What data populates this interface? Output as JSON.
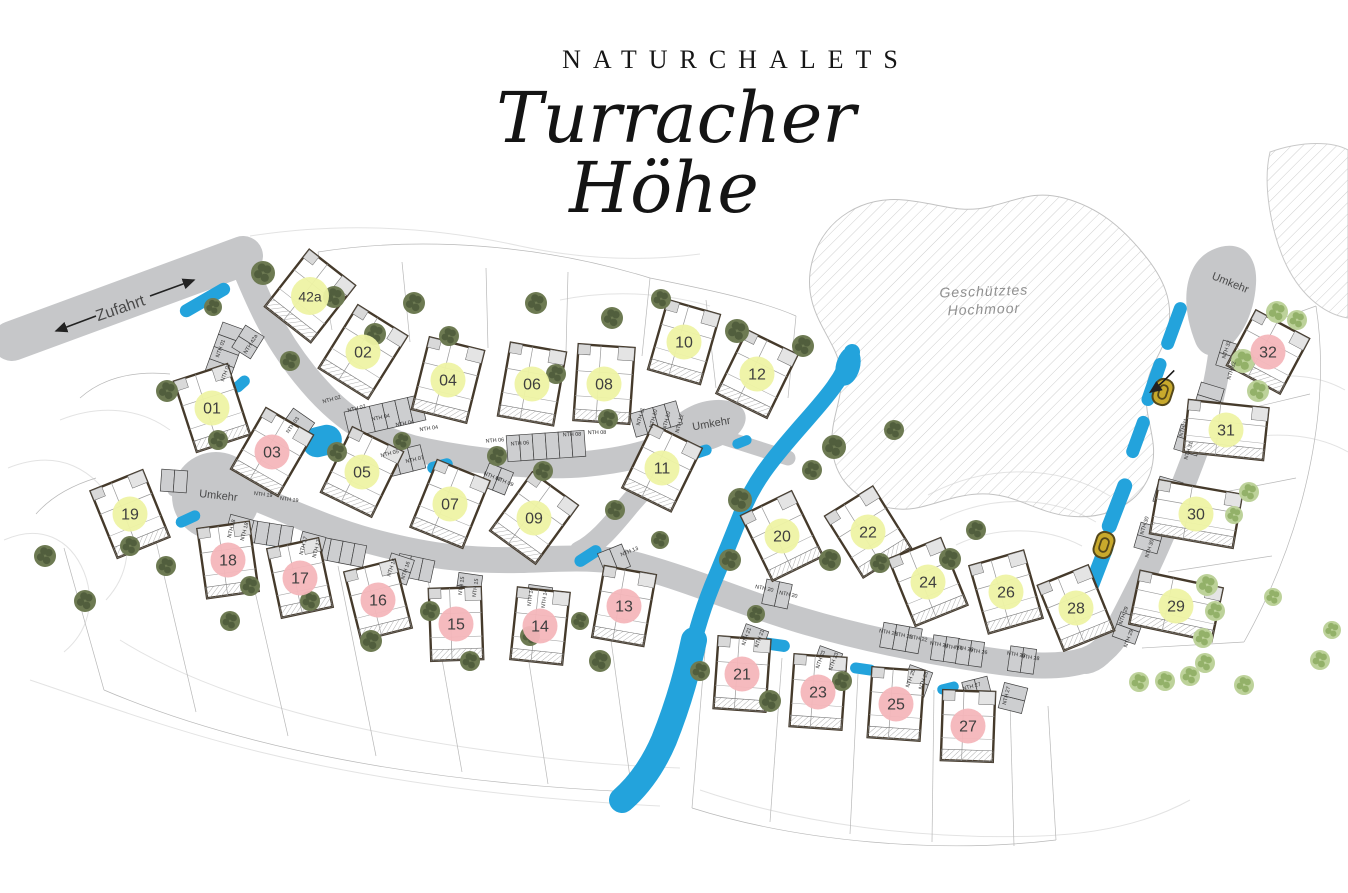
{
  "title": {
    "kicker": "NATURCHALETS",
    "line1": "Turracher",
    "line2": "Höhe"
  },
  "map_labels": {
    "zufahrt": "Zufahrt",
    "umkehr": "Umkehr",
    "moor1": "Geschütztes",
    "moor2": "Hochmoor"
  },
  "colors": {
    "badge_yellow": "#eef3a4",
    "badge_pink": "#f4b6ba",
    "road": "#c6c7c9",
    "water": "#23a3dc",
    "tree_dark": "#6d7a52",
    "tree_dark_spot": "#515e3d",
    "tree_light": "#bdd29a",
    "tree_light_spot": "#93b169",
    "wall": "#453a2b",
    "marker": "#c8a92c"
  },
  "umkehr_positions": [
    {
      "x": 218,
      "y": 499,
      "r": 6
    },
    {
      "x": 712,
      "y": 427,
      "r": -10
    },
    {
      "x": 1229,
      "y": 286,
      "r": 22
    }
  ],
  "moor_label_pos": {
    "x": 984,
    "y": 298
  },
  "zufahrt_pos": {
    "x": 122,
    "y": 313,
    "r": -19
  },
  "houses": [
    {
      "id": "42a",
      "x": 310,
      "y": 296,
      "rot": 38,
      "w": 58,
      "h": 72,
      "status": "yellow"
    },
    {
      "id": "01",
      "x": 212,
      "y": 408,
      "rot": -18,
      "w": 56,
      "h": 74,
      "status": "yellow"
    },
    {
      "id": "02",
      "x": 363,
      "y": 352,
      "rot": 32,
      "w": 58,
      "h": 74,
      "status": "yellow"
    },
    {
      "id": "03",
      "x": 272,
      "y": 452,
      "rot": 30,
      "w": 54,
      "h": 70,
      "status": "pink"
    },
    {
      "id": "04",
      "x": 448,
      "y": 380,
      "rot": 14,
      "w": 56,
      "h": 74,
      "status": "yellow"
    },
    {
      "id": "05",
      "x": 362,
      "y": 472,
      "rot": 26,
      "w": 56,
      "h": 72,
      "status": "yellow"
    },
    {
      "id": "06",
      "x": 532,
      "y": 384,
      "rot": 10,
      "w": 56,
      "h": 74,
      "status": "yellow"
    },
    {
      "id": "07",
      "x": 450,
      "y": 504,
      "rot": 22,
      "w": 56,
      "h": 72,
      "status": "yellow"
    },
    {
      "id": "08",
      "x": 604,
      "y": 384,
      "rot": 4,
      "w": 56,
      "h": 76,
      "status": "yellow"
    },
    {
      "id": "09",
      "x": 534,
      "y": 518,
      "rot": 36,
      "w": 56,
      "h": 72,
      "status": "yellow"
    },
    {
      "id": "10",
      "x": 684,
      "y": 342,
      "rot": 16,
      "w": 54,
      "h": 72,
      "status": "yellow"
    },
    {
      "id": "11",
      "x": 662,
      "y": 468,
      "rot": 26,
      "w": 54,
      "h": 70,
      "status": "yellow"
    },
    {
      "id": "12",
      "x": 757,
      "y": 374,
      "rot": 26,
      "w": 56,
      "h": 70,
      "status": "yellow"
    },
    {
      "id": "13",
      "x": 624,
      "y": 606,
      "rot": 10,
      "w": 52,
      "h": 72,
      "status": "pink"
    },
    {
      "id": "14",
      "x": 540,
      "y": 626,
      "rot": 6,
      "w": 52,
      "h": 72,
      "status": "pink"
    },
    {
      "id": "15",
      "x": 456,
      "y": 624,
      "rot": -2,
      "w": 52,
      "h": 72,
      "status": "pink"
    },
    {
      "id": "16",
      "x": 378,
      "y": 600,
      "rot": -14,
      "w": 52,
      "h": 70,
      "status": "pink"
    },
    {
      "id": "17",
      "x": 300,
      "y": 578,
      "rot": -12,
      "w": 52,
      "h": 70,
      "status": "pink"
    },
    {
      "id": "18",
      "x": 228,
      "y": 560,
      "rot": -8,
      "w": 52,
      "h": 70,
      "status": "pink"
    },
    {
      "id": "19",
      "x": 130,
      "y": 514,
      "rot": -22,
      "w": 56,
      "h": 72,
      "status": "yellow"
    },
    {
      "id": "20",
      "x": 782,
      "y": 536,
      "rot": -26,
      "w": 56,
      "h": 72,
      "status": "yellow"
    },
    {
      "id": "21",
      "x": 742,
      "y": 674,
      "rot": 4,
      "w": 52,
      "h": 72,
      "status": "pink"
    },
    {
      "id": "22",
      "x": 868,
      "y": 532,
      "rot": -32,
      "w": 56,
      "h": 72,
      "status": "yellow"
    },
    {
      "id": "23",
      "x": 818,
      "y": 692,
      "rot": 4,
      "w": 52,
      "h": 72,
      "status": "pink"
    },
    {
      "id": "24",
      "x": 928,
      "y": 582,
      "rot": -22,
      "w": 56,
      "h": 72,
      "status": "yellow"
    },
    {
      "id": "25",
      "x": 896,
      "y": 704,
      "rot": 4,
      "w": 52,
      "h": 70,
      "status": "pink"
    },
    {
      "id": "26",
      "x": 1006,
      "y": 592,
      "rot": -16,
      "w": 56,
      "h": 70,
      "status": "yellow"
    },
    {
      "id": "27",
      "x": 968,
      "y": 726,
      "rot": 2,
      "w": 52,
      "h": 70,
      "status": "pink"
    },
    {
      "id": "28",
      "x": 1076,
      "y": 608,
      "rot": -22,
      "w": 54,
      "h": 70,
      "status": "yellow"
    },
    {
      "id": "29",
      "x": 1176,
      "y": 606,
      "rot": 12,
      "w": 84,
      "h": 54,
      "status": "yellow"
    },
    {
      "id": "30",
      "x": 1196,
      "y": 514,
      "rot": 10,
      "w": 84,
      "h": 54,
      "status": "yellow"
    },
    {
      "id": "31",
      "x": 1226,
      "y": 430,
      "rot": 6,
      "w": 80,
      "h": 52,
      "status": "yellow"
    },
    {
      "id": "32",
      "x": 1268,
      "y": 352,
      "rot": 28,
      "w": 60,
      "h": 62,
      "status": "pink"
    }
  ],
  "nth_labels": [
    {
      "t": "NTH 01",
      "x": 222,
      "y": 349,
      "r": -70
    },
    {
      "t": "NTH 01",
      "x": 227,
      "y": 373,
      "r": -70
    },
    {
      "t": "NTH 42a",
      "x": 252,
      "y": 345,
      "r": -58
    },
    {
      "t": "NTH 02",
      "x": 332,
      "y": 401,
      "r": -15
    },
    {
      "t": "NTH 02",
      "x": 357,
      "y": 410,
      "r": -14
    },
    {
      "t": "NTH 04",
      "x": 381,
      "y": 419,
      "r": -12
    },
    {
      "t": "NTH 04",
      "x": 405,
      "y": 425,
      "r": -10
    },
    {
      "t": "NTH 04",
      "x": 429,
      "y": 430,
      "r": -8
    },
    {
      "t": "NTH 06",
      "x": 495,
      "y": 442,
      "r": -5
    },
    {
      "t": "NTH 06",
      "x": 520,
      "y": 445,
      "r": -4
    },
    {
      "t": "NTH 08",
      "x": 572,
      "y": 436,
      "r": -2
    },
    {
      "t": "NTH 08",
      "x": 597,
      "y": 434,
      "r": -1
    },
    {
      "t": "NTH 03",
      "x": 294,
      "y": 426,
      "r": -55
    },
    {
      "t": "NTH 05",
      "x": 390,
      "y": 455,
      "r": -14
    },
    {
      "t": "NTH 07",
      "x": 415,
      "y": 461,
      "r": -13
    },
    {
      "t": "NTH 07",
      "x": 492,
      "y": 478,
      "r": 22
    },
    {
      "t": "NTH 09",
      "x": 504,
      "y": 483,
      "r": 22
    },
    {
      "t": "NTH 11",
      "x": 642,
      "y": 417,
      "r": -75
    },
    {
      "t": "NTH 10",
      "x": 655,
      "y": 419,
      "r": -75
    },
    {
      "t": "NTH 10",
      "x": 668,
      "y": 421,
      "r": -75
    },
    {
      "t": "NTH 12",
      "x": 681,
      "y": 424,
      "r": -75
    },
    {
      "t": "NTH 13",
      "x": 630,
      "y": 553,
      "r": -22
    },
    {
      "t": "NTH 14",
      "x": 532,
      "y": 597,
      "r": -82
    },
    {
      "t": "NTH 14",
      "x": 546,
      "y": 599,
      "r": -82
    },
    {
      "t": "NTH 15",
      "x": 463,
      "y": 586,
      "r": -82
    },
    {
      "t": "NTH 15",
      "x": 477,
      "y": 588,
      "r": -82
    },
    {
      "t": "NTH 16",
      "x": 393,
      "y": 568,
      "r": -72
    },
    {
      "t": "NTH 16",
      "x": 407,
      "y": 571,
      "r": -72
    },
    {
      "t": "NTH 17",
      "x": 305,
      "y": 546,
      "r": -75
    },
    {
      "t": "NTH 17",
      "x": 318,
      "y": 549,
      "r": -75
    },
    {
      "t": "NTH 18",
      "x": 233,
      "y": 529,
      "r": -75
    },
    {
      "t": "NTH 18",
      "x": 246,
      "y": 532,
      "r": -75
    },
    {
      "t": "NTH 19",
      "x": 263,
      "y": 496,
      "r": 7
    },
    {
      "t": "NTH 19",
      "x": 289,
      "y": 501,
      "r": 8
    },
    {
      "t": "NTH 20",
      "x": 764,
      "y": 590,
      "r": 12
    },
    {
      "t": "NTH 20",
      "x": 788,
      "y": 596,
      "r": 12
    },
    {
      "t": "NTH 21",
      "x": 748,
      "y": 637,
      "r": -70
    },
    {
      "t": "NTH 21",
      "x": 761,
      "y": 639,
      "r": -70
    },
    {
      "t": "NTH 22",
      "x": 888,
      "y": 634,
      "r": 10
    },
    {
      "t": "NTH 22",
      "x": 903,
      "y": 637,
      "r": 10
    },
    {
      "t": "NTH 22",
      "x": 918,
      "y": 640,
      "r": 10
    },
    {
      "t": "NTH 23",
      "x": 822,
      "y": 660,
      "r": -70
    },
    {
      "t": "NTH 23",
      "x": 835,
      "y": 662,
      "r": -70
    },
    {
      "t": "NTH 24",
      "x": 939,
      "y": 646,
      "r": 8
    },
    {
      "t": "NTH 24",
      "x": 953,
      "y": 649,
      "r": 8
    },
    {
      "t": "NTH 26",
      "x": 964,
      "y": 650,
      "r": 8
    },
    {
      "t": "NTH 26",
      "x": 978,
      "y": 653,
      "r": 8
    },
    {
      "t": "NTH 25",
      "x": 912,
      "y": 679,
      "r": -70
    },
    {
      "t": "NTH 25",
      "x": 925,
      "y": 681,
      "r": -70
    },
    {
      "t": "NTH 28",
      "x": 1016,
      "y": 656,
      "r": 8
    },
    {
      "t": "NTH 28",
      "x": 1030,
      "y": 659,
      "r": 8
    },
    {
      "t": "NTH 27",
      "x": 972,
      "y": 688,
      "r": -14
    },
    {
      "t": "NTH 27",
      "x": 1008,
      "y": 696,
      "r": -76
    },
    {
      "t": "NTH 29",
      "x": 1125,
      "y": 616,
      "r": -70
    },
    {
      "t": "NTH 29",
      "x": 1130,
      "y": 639,
      "r": -70
    },
    {
      "t": "NTH 30",
      "x": 1146,
      "y": 526,
      "r": -73
    },
    {
      "t": "NTH 30",
      "x": 1151,
      "y": 549,
      "r": -73
    },
    {
      "t": "NTH 31",
      "x": 1185,
      "y": 428,
      "r": -73
    },
    {
      "t": "NTH 31",
      "x": 1190,
      "y": 451,
      "r": -73
    },
    {
      "t": "NTH 32",
      "x": 1228,
      "y": 350,
      "r": -73
    },
    {
      "t": "NTH 32",
      "x": 1233,
      "y": 371,
      "r": -73
    }
  ],
  "parking_rows": [
    {
      "x": 224,
      "y": 357,
      "r": -70,
      "n": 5,
      "bw": 13,
      "bh": 26
    },
    {
      "x": 248,
      "y": 342,
      "r": -58,
      "n": 2,
      "bw": 13,
      "bh": 22
    },
    {
      "x": 385,
      "y": 416,
      "r": -13,
      "n": 6,
      "bw": 13,
      "bh": 26
    },
    {
      "x": 546,
      "y": 446,
      "r": -4,
      "n": 6,
      "bw": 13,
      "bh": 26
    },
    {
      "x": 656,
      "y": 419,
      "r": -16,
      "n": 4,
      "bw": 12,
      "bh": 24
    },
    {
      "x": 296,
      "y": 427,
      "r": -55,
      "n": 2,
      "bw": 14,
      "bh": 26
    },
    {
      "x": 404,
      "y": 461,
      "r": -14,
      "n": 3,
      "bw": 13,
      "bh": 24
    },
    {
      "x": 497,
      "y": 479,
      "r": 22,
      "n": 2,
      "bw": 13,
      "bh": 24
    },
    {
      "x": 174,
      "y": 481,
      "r": 4,
      "n": 2,
      "bw": 13,
      "bh": 22
    },
    {
      "x": 268,
      "y": 534,
      "r": 9,
      "n": 4,
      "bw": 12,
      "bh": 22
    },
    {
      "x": 341,
      "y": 552,
      "r": 11,
      "n": 4,
      "bw": 12,
      "bh": 22
    },
    {
      "x": 415,
      "y": 568,
      "r": 12,
      "n": 3,
      "bw": 12,
      "bh": 22
    },
    {
      "x": 239,
      "y": 530,
      "r": -75,
      "n": 2,
      "bw": 13,
      "bh": 24
    },
    {
      "x": 311,
      "y": 547,
      "r": -75,
      "n": 2,
      "bw": 13,
      "bh": 24
    },
    {
      "x": 399,
      "y": 569,
      "r": -72,
      "n": 2,
      "bw": 13,
      "bh": 24
    },
    {
      "x": 469,
      "y": 587,
      "r": -82,
      "n": 2,
      "bw": 13,
      "bh": 24
    },
    {
      "x": 539,
      "y": 599,
      "r": -82,
      "n": 2,
      "bw": 13,
      "bh": 24
    },
    {
      "x": 614,
      "y": 560,
      "r": -22,
      "n": 2,
      "bw": 13,
      "bh": 24
    },
    {
      "x": 777,
      "y": 594,
      "r": 12,
      "n": 2,
      "bw": 13,
      "bh": 25
    },
    {
      "x": 901,
      "y": 638,
      "r": 10,
      "n": 3,
      "bw": 13,
      "bh": 25
    },
    {
      "x": 945,
      "y": 649,
      "r": 8,
      "n": 2,
      "bw": 13,
      "bh": 25
    },
    {
      "x": 970,
      "y": 653,
      "r": 8,
      "n": 2,
      "bw": 13,
      "bh": 25
    },
    {
      "x": 1022,
      "y": 660,
      "r": 8,
      "n": 2,
      "bw": 13,
      "bh": 25
    },
    {
      "x": 753,
      "y": 640,
      "r": -70,
      "n": 2,
      "bw": 13,
      "bh": 24
    },
    {
      "x": 827,
      "y": 662,
      "r": -70,
      "n": 2,
      "bw": 13,
      "bh": 24
    },
    {
      "x": 917,
      "y": 681,
      "r": -70,
      "n": 2,
      "bw": 13,
      "bh": 24
    },
    {
      "x": 1013,
      "y": 698,
      "r": -76,
      "n": 2,
      "bw": 13,
      "bh": 24
    },
    {
      "x": 977,
      "y": 690,
      "r": -14,
      "n": 2,
      "bw": 13,
      "bh": 22
    },
    {
      "x": 1231,
      "y": 356,
      "r": -73,
      "n": 2,
      "bw": 13,
      "bh": 24
    },
    {
      "x": 1209,
      "y": 398,
      "r": -73,
      "n": 2,
      "bw": 13,
      "bh": 24
    },
    {
      "x": 1189,
      "y": 440,
      "r": -73,
      "n": 2,
      "bw": 13,
      "bh": 24
    },
    {
      "x": 1168,
      "y": 492,
      "r": -74,
      "n": 2,
      "bw": 13,
      "bh": 24
    },
    {
      "x": 1149,
      "y": 538,
      "r": -74,
      "n": 2,
      "bw": 13,
      "bh": 24
    },
    {
      "x": 1128,
      "y": 628,
      "r": -70,
      "n": 2,
      "bw": 13,
      "bh": 24
    }
  ],
  "water": [
    {
      "x": 205,
      "y": 300,
      "w": 56,
      "h": 13,
      "r": -30
    },
    {
      "x": 241,
      "y": 384,
      "w": 20,
      "h": 11,
      "r": -42
    },
    {
      "x": 322,
      "y": 441,
      "w": 40,
      "h": 30,
      "r": -14
    },
    {
      "x": 440,
      "y": 466,
      "w": 26,
      "h": 12,
      "r": -14
    },
    {
      "x": 188,
      "y": 519,
      "w": 26,
      "h": 11,
      "r": -25
    },
    {
      "x": 275,
      "y": 541,
      "w": 28,
      "h": 11,
      "r": 9
    },
    {
      "x": 347,
      "y": 558,
      "w": 28,
      "h": 11,
      "r": 10
    },
    {
      "x": 417,
      "y": 571,
      "w": 24,
      "h": 11,
      "r": 12
    },
    {
      "x": 588,
      "y": 556,
      "w": 30,
      "h": 12,
      "r": -33
    },
    {
      "x": 700,
      "y": 452,
      "w": 24,
      "h": 11,
      "r": -18
    },
    {
      "x": 742,
      "y": 442,
      "w": 20,
      "h": 10,
      "r": -22
    },
    {
      "x": 770,
      "y": 644,
      "w": 40,
      "h": 12,
      "r": 8
    },
    {
      "x": 863,
      "y": 669,
      "w": 26,
      "h": 11,
      "r": 8
    },
    {
      "x": 948,
      "y": 688,
      "w": 22,
      "h": 10,
      "r": -14
    },
    {
      "x": 1174,
      "y": 326,
      "w": 13,
      "h": 50,
      "r": 20
    },
    {
      "x": 1154,
      "y": 382,
      "w": 13,
      "h": 50,
      "r": 19
    },
    {
      "x": 1138,
      "y": 437,
      "w": 13,
      "h": 44,
      "r": 20
    },
    {
      "x": 1117,
      "y": 506,
      "w": 15,
      "h": 58,
      "r": 21
    },
    {
      "x": 1099,
      "y": 566,
      "w": 15,
      "h": 54,
      "r": 21
    }
  ],
  "trees": {
    "dark": [
      [
        263,
        273,
        12
      ],
      [
        334,
        297,
        11
      ],
      [
        414,
        303,
        11
      ],
      [
        536,
        303,
        11
      ],
      [
        612,
        318,
        11
      ],
      [
        661,
        299,
        10
      ],
      [
        737,
        331,
        12
      ],
      [
        803,
        346,
        11
      ],
      [
        213,
        307,
        9
      ],
      [
        167,
        391,
        11
      ],
      [
        290,
        361,
        10
      ],
      [
        375,
        334,
        11
      ],
      [
        449,
        336,
        10
      ],
      [
        556,
        374,
        10
      ],
      [
        608,
        419,
        10
      ],
      [
        834,
        447,
        12
      ],
      [
        218,
        440,
        10
      ],
      [
        337,
        452,
        10
      ],
      [
        402,
        441,
        9
      ],
      [
        497,
        456,
        10
      ],
      [
        543,
        471,
        10
      ],
      [
        740,
        500,
        12
      ],
      [
        730,
        560,
        11
      ],
      [
        830,
        560,
        11
      ],
      [
        950,
        559,
        11
      ],
      [
        976,
        530,
        10
      ],
      [
        880,
        563,
        10
      ],
      [
        45,
        556,
        11
      ],
      [
        85,
        601,
        11
      ],
      [
        130,
        546,
        10
      ],
      [
        166,
        566,
        10
      ],
      [
        250,
        586,
        10
      ],
      [
        230,
        621,
        10
      ],
      [
        310,
        601,
        10
      ],
      [
        371,
        641,
        11
      ],
      [
        430,
        611,
        10
      ],
      [
        470,
        661,
        10
      ],
      [
        530,
        636,
        10
      ],
      [
        600,
        661,
        11
      ],
      [
        580,
        621,
        9
      ],
      [
        700,
        671,
        10
      ],
      [
        770,
        701,
        11
      ],
      [
        842,
        681,
        10
      ],
      [
        756,
        614,
        9
      ],
      [
        615,
        510,
        10
      ],
      [
        660,
        540,
        9
      ],
      [
        812,
        470,
        10
      ],
      [
        894,
        430,
        10
      ]
    ],
    "light": [
      [
        1277,
        312,
        11
      ],
      [
        1297,
        320,
        10
      ],
      [
        1243,
        361,
        12
      ],
      [
        1258,
        391,
        11
      ],
      [
        1249,
        492,
        10
      ],
      [
        1234,
        515,
        9
      ],
      [
        1207,
        585,
        11
      ],
      [
        1273,
        597,
        9
      ],
      [
        1215,
        611,
        10
      ],
      [
        1203,
        638,
        10
      ],
      [
        1190,
        676,
        10
      ],
      [
        1165,
        681,
        10
      ],
      [
        1139,
        682,
        10
      ],
      [
        1205,
        663,
        10
      ],
      [
        1244,
        685,
        10
      ],
      [
        1320,
        660,
        10
      ],
      [
        1332,
        630,
        9
      ]
    ]
  },
  "markers": [
    {
      "x": 1163,
      "y": 392,
      "arrow": true
    },
    {
      "x": 1104,
      "y": 545,
      "arrow": false
    }
  ]
}
